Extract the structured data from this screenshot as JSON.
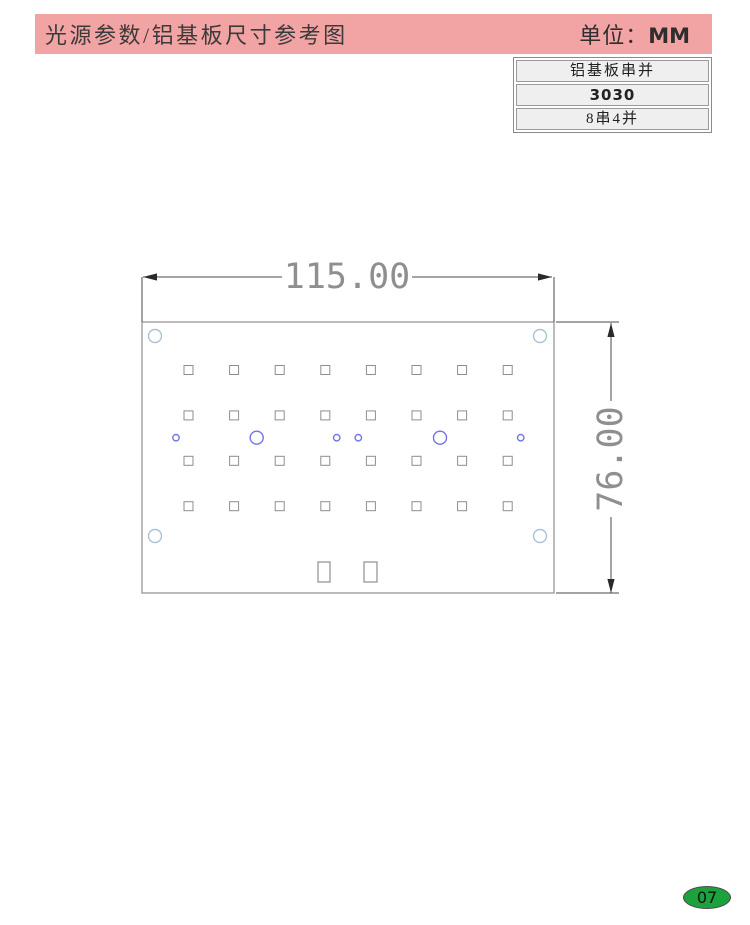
{
  "header": {
    "title": "光源参数/铝基板尺寸参考图",
    "unit_prefix": "单位：",
    "unit_value": "MM",
    "bg": "#f2a3a3"
  },
  "spec_table": {
    "rows": [
      "铝基板串并",
      "3030",
      "8串4并"
    ]
  },
  "drawing": {
    "width_label": "115.00",
    "height_label": "76.00",
    "stroke": "#8e8e8e",
    "dim_color": "#4a4a4a",
    "arrow_color": "#2a2a2a",
    "text_color": "#8f8f8f",
    "hole_color": "#a9c2d6",
    "via_color": "#7373e8",
    "board": {
      "x": 142,
      "y": 322,
      "w": 412,
      "h": 271
    },
    "dim_top": {
      "y": 277,
      "x1": 143,
      "x2": 552,
      "gap1": 282,
      "gap2": 412,
      "text_x": 347,
      "ext_y2": 322
    },
    "dim_right": {
      "x": 611,
      "y1": 323,
      "y2": 593,
      "gap1": 401,
      "gap2": 517,
      "text_y": 459,
      "ext_x1": 556,
      "ext_x2": 619
    },
    "corner_holes": {
      "r": 6.5,
      "centers": [
        [
          155,
          336
        ],
        [
          540,
          336
        ],
        [
          155,
          536
        ],
        [
          540,
          536
        ]
      ]
    },
    "led_grid": {
      "cols": 8,
      "rows": 4,
      "x0": 188.5,
      "y0": 370,
      "dx": 45.6,
      "dy": 45.4,
      "size": 9
    },
    "vias": {
      "y": 437.7,
      "items": [
        {
          "x": 176,
          "r": 3.2
        },
        {
          "x": 256.7,
          "r": 6.5
        },
        {
          "x": 336.7,
          "r": 3.2
        },
        {
          "x": 358.3,
          "r": 3.2
        },
        {
          "x": 440,
          "r": 6.5
        },
        {
          "x": 520.7,
          "r": 3.2
        }
      ]
    },
    "connector_pads": [
      {
        "x": 318,
        "y": 562,
        "w": 12,
        "h": 20
      },
      {
        "x": 364,
        "y": 562,
        "w": 13,
        "h": 20
      }
    ]
  },
  "footer": {
    "page_number": "07",
    "badge_color": "#1ca23c"
  }
}
